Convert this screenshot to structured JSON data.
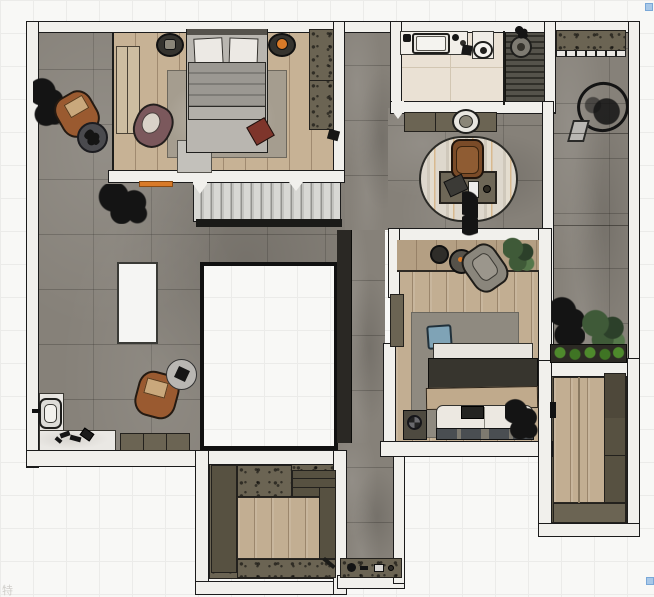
{
  "scene": {
    "title": "floor-plan-top-view",
    "watermark": "特",
    "handle_color": "#a8c8e8",
    "stairs": {
      "treads_visible": 14
    }
  },
  "palette": {
    "grid": "#ebebe9",
    "wall_fill": "#f1f0ec",
    "wall_line": "#1b1b1b",
    "concrete": "#868179",
    "wood_master": "#c7b295",
    "wood_secondary": "#c2ae92",
    "bathroom_tile": "#eae1d4",
    "shower_slat": "#302f29",
    "cabinet_olive": "#6b6453",
    "cabinet_olive_dark": "#575141",
    "rug_master": "#a59d8f",
    "rug_bedroom2": "#8f8a80",
    "duvet_dark": "#37352e",
    "blanket_beige": "#c0aa8c",
    "pillow_blue": "#7fa3b6",
    "leather_brown": "#9a5a30",
    "chair_mauve": "#7b585c",
    "accent_orange": "#d97a28",
    "box_red": "#7e352b",
    "plant_green_dark": "#3f5a38",
    "planter_green": "#4e8a2c",
    "marble": "#eae8e4",
    "island_white": "#f5f5f3"
  },
  "rooms": {
    "master_bedroom": {
      "furniture": [
        "wardrobe",
        "dresser",
        "area-rug",
        "double-bed",
        "pillows",
        "nightstand-left",
        "nightstand-right",
        "lounge-chair",
        "storage-box",
        "closet",
        "doormat"
      ]
    },
    "living_area": {
      "furniture": [
        "plant",
        "plant-2",
        "leather-armchair",
        "side-table",
        "leather-armchair-2",
        "side-table-2",
        "kitchen-island",
        "sideboard",
        "toilet",
        "scattered-shoes"
      ]
    },
    "stairwell": {
      "furniture": [
        "staircase"
      ]
    },
    "void_opening": {
      "furniture": []
    },
    "bathroom": {
      "furniture": [
        "vanity-counter",
        "bathtub",
        "pedestal-sink",
        "shower",
        "shower-head"
      ]
    },
    "study_nook": {
      "furniture": [
        "sideboard",
        "round-basin",
        "oval-rug",
        "desk",
        "desk-chair",
        "laptop",
        "notepad",
        "plant"
      ]
    },
    "bedroom_2": {
      "furniture": [
        "shelf-band",
        "round-table-small",
        "round-table-large",
        "armchair",
        "plant",
        "area-rug",
        "blue-cushion",
        "double-bed",
        "bedside-cabinet",
        "fan",
        "plant-2",
        "wardrobe"
      ]
    },
    "hallway": {
      "furniture": [
        "tall-cabinet",
        "counter-with-kettle"
      ]
    },
    "walk_in_closet": {
      "furniture": [
        "cabinet-run",
        "wood-floor-inlay"
      ]
    },
    "terrace_right": {
      "furniture": [
        "planter-box",
        "hanging-chair",
        "shrub-dark",
        "shrub-green",
        "flower-planter"
      ]
    },
    "laundry_room": {
      "furniture": [
        "cabinet-column",
        "cabinet-row",
        "door-mark"
      ]
    }
  }
}
